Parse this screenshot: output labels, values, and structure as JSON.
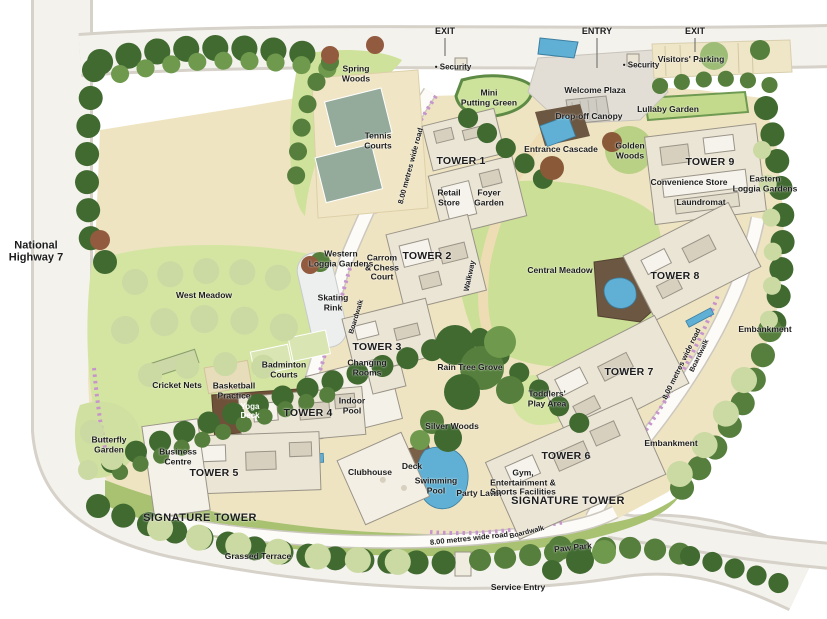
{
  "map": {
    "title": "Residential development master site plan",
    "palette": {
      "highway_road": "#f4f2ed",
      "road_casing": "#d6d2c9",
      "site_base": "#efe4c2",
      "meadow_green": "#d4e5a2",
      "central_meadow_green": "#cbdf96",
      "tree_dark": "#416a31",
      "tree_mid": "#567f3d",
      "tree_light": "#6f9a4e",
      "tree_pale": "#9dbd77",
      "meadow_tree_pale": "#cbd9a3",
      "water_blue": "#5fb0d4",
      "deck_brown": "#6e5138",
      "boardwalk_purple": "#c795cb",
      "building_cream": "#ebe5d6",
      "building_white": "#f4f1e9",
      "court_green_gray": "#94aa9b",
      "plaza_gray": "#e2ded6",
      "label_text": "#1c1c1c"
    },
    "labels": [
      {
        "id": "national-highway-7",
        "text": "National\nHighway 7",
        "x": 36,
        "y": 252,
        "s": 11
      },
      {
        "id": "exit-left",
        "text": "EXIT",
        "x": 445,
        "y": 31,
        "s": 9
      },
      {
        "id": "entry",
        "text": "ENTRY",
        "x": 597,
        "y": 31,
        "s": 9
      },
      {
        "id": "exit-right",
        "text": "EXIT",
        "x": 695,
        "y": 31,
        "s": 9
      },
      {
        "id": "security-left",
        "text": "• Security",
        "x": 453,
        "y": 68,
        "s": 8
      },
      {
        "id": "security-right",
        "text": "• Security",
        "x": 641,
        "y": 66,
        "s": 8
      },
      {
        "id": "visitors-parking",
        "text": "Visitors' Parking",
        "x": 691,
        "y": 60
      },
      {
        "id": "welcome-plaza",
        "text": "Welcome Plaza",
        "x": 595,
        "y": 91
      },
      {
        "id": "mini-putting-green",
        "text": "Mini\nPutting Green",
        "x": 489,
        "y": 98
      },
      {
        "id": "drop-off-canopy",
        "text": "Drop-off Canopy",
        "x": 589,
        "y": 117
      },
      {
        "id": "lullaby-garden",
        "text": "Lullaby Garden",
        "x": 668,
        "y": 110
      },
      {
        "id": "spring-woods",
        "text": "Spring\nWoods",
        "x": 356,
        "y": 74
      },
      {
        "id": "tennis-courts",
        "text": "Tennis\nCourts",
        "x": 378,
        "y": 141
      },
      {
        "id": "road-8m-top",
        "text": "8.00 metres wide road",
        "x": 411,
        "y": 166,
        "s": 7.5,
        "rot": -75
      },
      {
        "id": "tower-1",
        "text": "TOWER 1",
        "x": 461,
        "y": 162,
        "s": 10.5,
        "cls": "tower"
      },
      {
        "id": "retail-store",
        "text": "Retail\nStore",
        "x": 449,
        "y": 198
      },
      {
        "id": "foyer-garden",
        "text": "Foyer\nGarden",
        "x": 489,
        "y": 198
      },
      {
        "id": "entrance-cascade",
        "text": "Entrance Cascade",
        "x": 561,
        "y": 150
      },
      {
        "id": "golden-woods",
        "text": "Golden\nWoods",
        "x": 630,
        "y": 151
      },
      {
        "id": "tower-9",
        "text": "TOWER 9",
        "x": 710,
        "y": 163,
        "s": 10.5,
        "cls": "tower"
      },
      {
        "id": "convenience-store",
        "text": "Convenience Store",
        "x": 689,
        "y": 183
      },
      {
        "id": "laundromat",
        "text": "Laundromat",
        "x": 701,
        "y": 203
      },
      {
        "id": "eastern-loggia-gardens",
        "text": "Eastern\nLoggia Gardens",
        "x": 765,
        "y": 184
      },
      {
        "id": "western-loggia-gardens",
        "text": "Western\nLoggia Gardens",
        "x": 341,
        "y": 259
      },
      {
        "id": "carrom-chess-court",
        "text": "Carrom\n& Chess\nCourt",
        "x": 382,
        "y": 268
      },
      {
        "id": "tower-2",
        "text": "TOWER 2",
        "x": 427,
        "y": 257,
        "s": 10.5,
        "cls": "tower"
      },
      {
        "id": "walkway",
        "text": "Walkway",
        "x": 470,
        "y": 276,
        "s": 7.5,
        "rot": -78
      },
      {
        "id": "central-meadow",
        "text": "Central Meadow",
        "x": 560,
        "y": 271
      },
      {
        "id": "tower-8",
        "text": "TOWER 8",
        "x": 675,
        "y": 277,
        "s": 10.5,
        "cls": "tower"
      },
      {
        "id": "skating-rink",
        "text": "Skating\nRink",
        "x": 333,
        "y": 303
      },
      {
        "id": "boardwalk-left",
        "text": "Boardwalk",
        "x": 357,
        "y": 317,
        "s": 7,
        "rot": -73
      },
      {
        "id": "tower-3",
        "text": "TOWER 3",
        "x": 377,
        "y": 348,
        "s": 10.5,
        "cls": "tower"
      },
      {
        "id": "changing-rooms",
        "text": "Changing\nRooms",
        "x": 367,
        "y": 368
      },
      {
        "id": "rain-tree-grove",
        "text": "Rain Tree Grove",
        "x": 470,
        "y": 368
      },
      {
        "id": "badminton-courts",
        "text": "Badminton\nCourts",
        "x": 284,
        "y": 370
      },
      {
        "id": "west-meadow",
        "text": "West Meadow",
        "x": 204,
        "y": 296
      },
      {
        "id": "cricket-nets",
        "text": "Cricket Nets",
        "x": 177,
        "y": 386
      },
      {
        "id": "basketball-practice",
        "text": "Basketball\nPractice",
        "x": 234,
        "y": 391
      },
      {
        "id": "yoga-deck",
        "text": "Yoga\nDeck",
        "x": 250,
        "y": 412,
        "s": 8,
        "color": "#ffffff"
      },
      {
        "id": "tower-4",
        "text": "TOWER 4",
        "x": 308,
        "y": 414,
        "s": 10.5,
        "cls": "tower"
      },
      {
        "id": "indoor-pool",
        "text": "Indoor\nPool",
        "x": 352,
        "y": 406
      },
      {
        "id": "toddlers-play-area",
        "text": "Toddlers'\nPlay Area",
        "x": 547,
        "y": 399
      },
      {
        "id": "tower-7",
        "text": "TOWER 7",
        "x": 629,
        "y": 373,
        "s": 10.5,
        "cls": "tower"
      },
      {
        "id": "road-8m-right",
        "text": "8.00 metres wide road",
        "x": 682,
        "y": 364,
        "s": 7.5,
        "rot": -64
      },
      {
        "id": "boardwalk-right",
        "text": "Boardwalk",
        "x": 700,
        "y": 356,
        "s": 7,
        "rot": -64
      },
      {
        "id": "embankment-right",
        "text": "Embankment",
        "x": 765,
        "y": 330
      },
      {
        "id": "embankment-lower",
        "text": "Embankment",
        "x": 671,
        "y": 444
      },
      {
        "id": "butterfly-garden",
        "text": "Butterfly\nGarden",
        "x": 109,
        "y": 445
      },
      {
        "id": "business-centre",
        "text": "Business\nCentre",
        "x": 178,
        "y": 457
      },
      {
        "id": "tower-5",
        "text": "TOWER 5",
        "x": 214,
        "y": 474,
        "s": 10.5,
        "cls": "tower"
      },
      {
        "id": "clubhouse",
        "text": "Clubhouse",
        "x": 370,
        "y": 473
      },
      {
        "id": "deck-clubhouse",
        "text": "Deck",
        "x": 412,
        "y": 467
      },
      {
        "id": "swimming-pool",
        "text": "Swimming\nPool",
        "x": 436,
        "y": 486
      },
      {
        "id": "party-lawn",
        "text": "Party Lawn",
        "x": 479,
        "y": 494
      },
      {
        "id": "silver-woods",
        "text": "Silver Woods",
        "x": 452,
        "y": 427
      },
      {
        "id": "tower-6",
        "text": "TOWER 6",
        "x": 566,
        "y": 457,
        "s": 10.5,
        "cls": "tower"
      },
      {
        "id": "gym-entertainment",
        "text": "Gym,\nEntertainment &\nSports Facilities",
        "x": 523,
        "y": 483
      },
      {
        "id": "signature-tower-right",
        "text": "SIGNATURE TOWER",
        "x": 568,
        "y": 501,
        "s": 11,
        "cls": "sig"
      },
      {
        "id": "signature-tower-left",
        "text": "SIGNATURE TOWER",
        "x": 200,
        "y": 518,
        "s": 11,
        "cls": "sig"
      },
      {
        "id": "grassed-terrace",
        "text": "Grassed Terrace",
        "x": 258,
        "y": 557
      },
      {
        "id": "road-8m-bottom",
        "text": "8.00 metres wide road",
        "x": 469,
        "y": 539,
        "s": 7.5,
        "rot": -6
      },
      {
        "id": "boardwalk-bottom",
        "text": "Boardwalk",
        "x": 527,
        "y": 533,
        "s": 7,
        "rot": -14
      },
      {
        "id": "paw-park",
        "text": "Paw Park",
        "x": 573,
        "y": 548,
        "rot": -6
      },
      {
        "id": "service-entry",
        "text": "Service Entry",
        "x": 518,
        "y": 588
      }
    ]
  }
}
